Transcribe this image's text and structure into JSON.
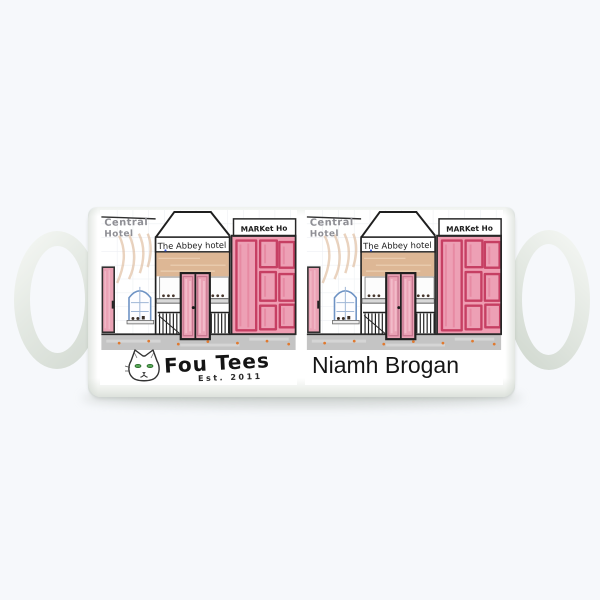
{
  "product": {
    "background_color": "#f6f8fb",
    "mug_color": "#ffffff"
  },
  "drawing": {
    "signs": {
      "left_line1": "Central",
      "left_line2": "Hotel",
      "center": "The Abbey hotel",
      "right": "MARKet Ho"
    },
    "colors": {
      "pencil": "#2f2f2f",
      "pencil_text": "#8f8f95",
      "door_pink": "#eaa2b5",
      "market_pink": "#ef9db2",
      "market_outline": "#c63f63",
      "facade_tan": "#ddb795",
      "window_blue": "#6e93c4",
      "ground_gray": "#c4c4c4",
      "accent_dot_orange": "#e0792f"
    }
  },
  "brand": {
    "name": "Fou Tees",
    "established": "Est. 2011",
    "mascot": "cat-face-icon",
    "eye_color": "#57a557"
  },
  "personalization": {
    "name": "Niamh Brogan"
  }
}
